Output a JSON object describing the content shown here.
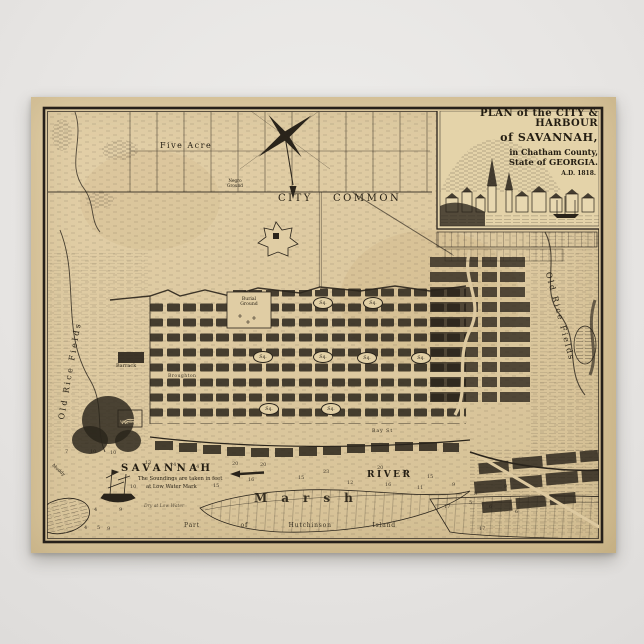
{
  "poster": {
    "title": {
      "line1": "PLAN of the CITY & HARBOUR",
      "line2": "of SAVANNAH,",
      "line3": "in Chatham County,",
      "line4": "State of GEORGIA.",
      "line5": "A.D. 1818."
    },
    "map_labels": {
      "five_acre": "Five Acre",
      "negro_ground": "Negro\nGround",
      "city": "CITY",
      "common": "COMMON",
      "burial_ground": "Burial\nGround",
      "barrack": "Barrack",
      "broughton": "Broughton",
      "wagon": "Wagon",
      "bay_st": "Bay St",
      "savannah": "SAVANNAH",
      "river": "RIVER",
      "soundings_note_1": "The Soundings are taken in feet",
      "soundings_note_2": "at Low Water Mark",
      "dry_low_water": "Dry at Low Water",
      "marsh": "Marsh",
      "hutchinson": "Part of Hutchinson Island",
      "old_rice_fields_west": "Old Rice Fields",
      "old_rice_fields_east": "Old Rice Fields",
      "muddy": "Muddy"
    },
    "squares_label": "Sq.",
    "squares": [
      {
        "x": 322,
        "y": 302
      },
      {
        "x": 372,
        "y": 302
      },
      {
        "x": 262,
        "y": 356
      },
      {
        "x": 322,
        "y": 356
      },
      {
        "x": 366,
        "y": 357
      },
      {
        "x": 420,
        "y": 357
      },
      {
        "x": 268,
        "y": 408
      },
      {
        "x": 330,
        "y": 408
      }
    ],
    "soundings": [
      {
        "x": 68,
        "y": 452,
        "v": "7"
      },
      {
        "x": 93,
        "y": 452,
        "v": "10"
      },
      {
        "x": 113,
        "y": 453,
        "v": "10"
      },
      {
        "x": 148,
        "y": 463,
        "v": "13"
      },
      {
        "x": 173,
        "y": 465,
        "v": "14"
      },
      {
        "x": 196,
        "y": 467,
        "v": "14"
      },
      {
        "x": 235,
        "y": 464,
        "v": "20"
      },
      {
        "x": 263,
        "y": 465,
        "v": "20"
      },
      {
        "x": 301,
        "y": 478,
        "v": "15"
      },
      {
        "x": 326,
        "y": 472,
        "v": "23"
      },
      {
        "x": 216,
        "y": 486,
        "v": "15"
      },
      {
        "x": 251,
        "y": 480,
        "v": "16"
      },
      {
        "x": 133,
        "y": 487,
        "v": "10"
      },
      {
        "x": 97,
        "y": 510,
        "v": "4"
      },
      {
        "x": 122,
        "y": 510,
        "v": "9"
      },
      {
        "x": 87,
        "y": 528,
        "v": "4"
      },
      {
        "x": 100,
        "y": 528,
        "v": "5"
      },
      {
        "x": 110,
        "y": 529,
        "v": "9"
      },
      {
        "x": 380,
        "y": 468,
        "v": "20"
      },
      {
        "x": 405,
        "y": 472,
        "v": "20"
      },
      {
        "x": 430,
        "y": 477,
        "v": "15"
      },
      {
        "x": 455,
        "y": 485,
        "v": "9"
      },
      {
        "x": 477,
        "y": 494,
        "v": "8"
      },
      {
        "x": 472,
        "y": 503,
        "v": "5"
      },
      {
        "x": 492,
        "y": 507,
        "v": "6"
      },
      {
        "x": 447,
        "y": 507,
        "v": "17"
      },
      {
        "x": 350,
        "y": 483,
        "v": "12"
      },
      {
        "x": 388,
        "y": 485,
        "v": "16"
      },
      {
        "x": 420,
        "y": 488,
        "v": "11"
      },
      {
        "x": 482,
        "y": 529,
        "v": "17"
      },
      {
        "x": 507,
        "y": 487,
        "v": "9"
      },
      {
        "x": 518,
        "y": 512,
        "v": "6"
      }
    ],
    "colors": {
      "background": "#e9e7e5",
      "paper": "#ddc9a0",
      "ink": "#2a241b"
    }
  }
}
